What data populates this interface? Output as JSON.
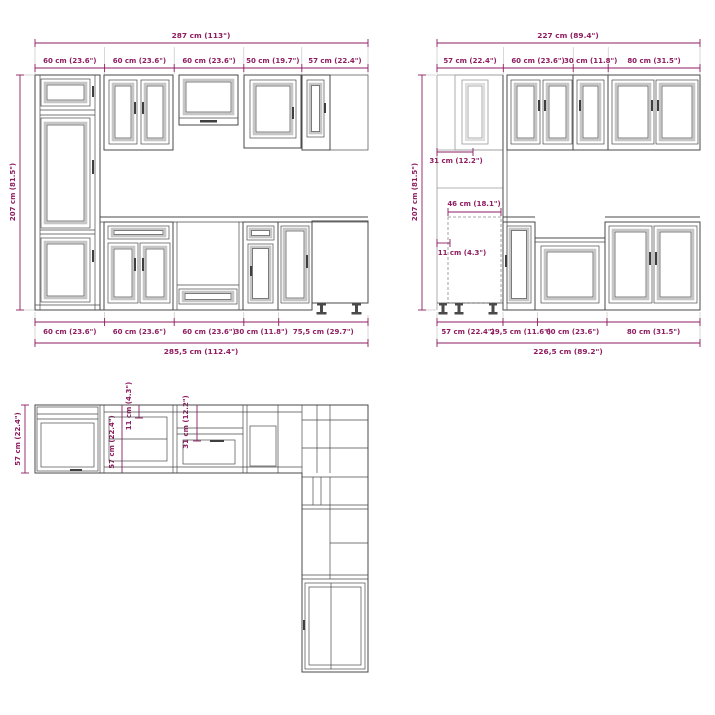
{
  "diagram_title": "kitchen-cabinet-set-dimension-drawing",
  "colors": {
    "dimension": "#8e1c60",
    "line": "#4a4a4a",
    "background": "#ffffff"
  },
  "front_view": {
    "overall_width": "287 cm (113\")",
    "top_segments": [
      "60 cm (23.6\")",
      "60 cm (23.6\")",
      "60 cm (23.6\")",
      "50 cm (19.7\")",
      "57 cm (22.4\")"
    ],
    "height": "207 cm (81.5\")",
    "bottom_segments": [
      "60 cm (23.6\")",
      "60 cm (23.6\")",
      "60 cm (23.6\")",
      "30 cm (11.8\")",
      "75,5 cm (29.7\")"
    ],
    "overall_width_bottom": "285,5 cm (112.4\")"
  },
  "side_view": {
    "overall_width": "227 cm (89.4\")",
    "top_segments": [
      "57 cm (22.4\")",
      "60 cm (23.6\")",
      "30 cm (11.8\")",
      "80 cm (31.5\")"
    ],
    "height": "207 cm (81.5\")",
    "inner_segments": [
      "31 cm (12.2\")",
      "46 cm (18.1\")",
      "11 cm (4.3\")"
    ],
    "bottom_segments": [
      "57 cm (22.4\")",
      "29,5 cm (11.6\")",
      "60 cm (23.6\")",
      "80 cm (31.5\")"
    ],
    "overall_width_bottom": "226,5 cm (89.2\")"
  },
  "plan_view": {
    "depth": "57 cm (22.4\")",
    "inner_segments": [
      "57 cm (22.4\")",
      "11 cm (4.3\")",
      "31 cm (12.2\")"
    ]
  }
}
